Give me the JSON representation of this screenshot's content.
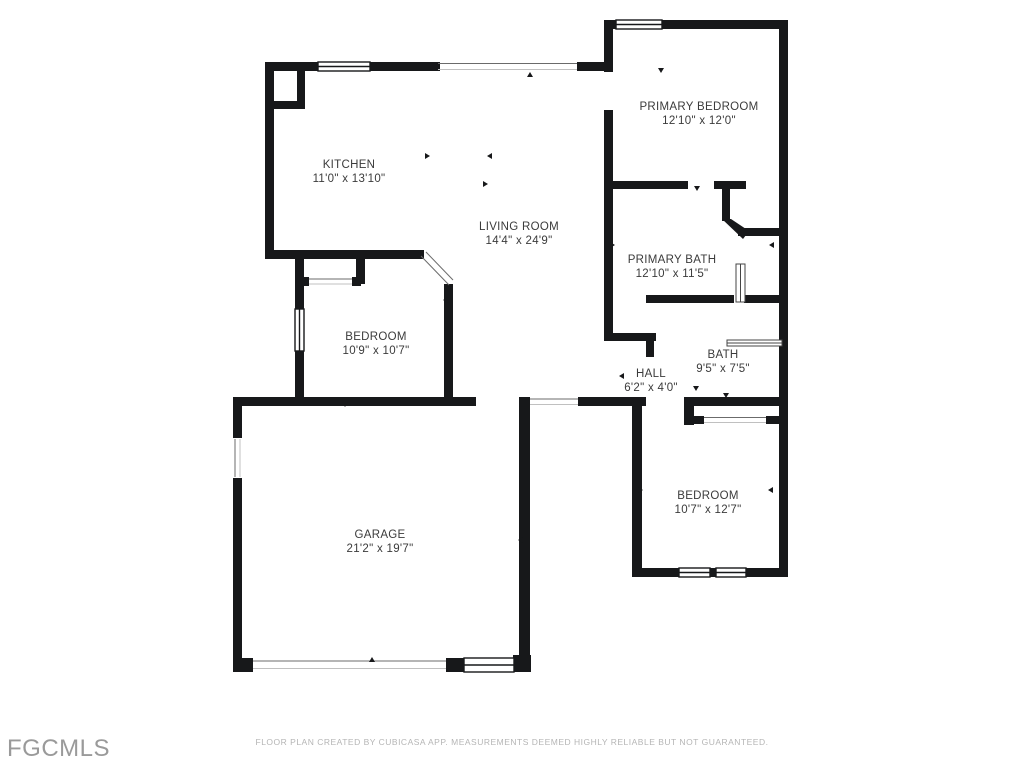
{
  "colors": {
    "wall": "#17181a",
    "label": "#3b3b3b",
    "muted": "#b5b5b5",
    "logo": "#9a9a9a"
  },
  "branding": {
    "logo": "FGCMLS"
  },
  "footer": {
    "disclaimer": "FLOOR PLAN CREATED BY CUBICASA APP. MEASUREMENTS DEEMED HIGHLY RELIABLE BUT NOT GUARANTEED."
  },
  "rooms": [
    {
      "name": "KITCHEN",
      "dims": "11'0\" x 13'10\""
    },
    {
      "name": "LIVING ROOM",
      "dims": "14'4\" x 24'9\""
    },
    {
      "name": "PRIMARY BEDROOM",
      "dims": "12'10\" x 12'0\""
    },
    {
      "name": "PRIMARY BATH",
      "dims": "12'10\" x 11'5\""
    },
    {
      "name": "BEDROOM",
      "dims": "10'9\" x 10'7\""
    },
    {
      "name": "HALL",
      "dims": "6'2\" x 4'0\""
    },
    {
      "name": "BATH",
      "dims": "9'5\" x 7'5\""
    },
    {
      "name": "GARAGE",
      "dims": "21'2\" x 19'7\""
    },
    {
      "name": "BEDROOM",
      "dims": "10'7\" x 12'7\""
    }
  ]
}
